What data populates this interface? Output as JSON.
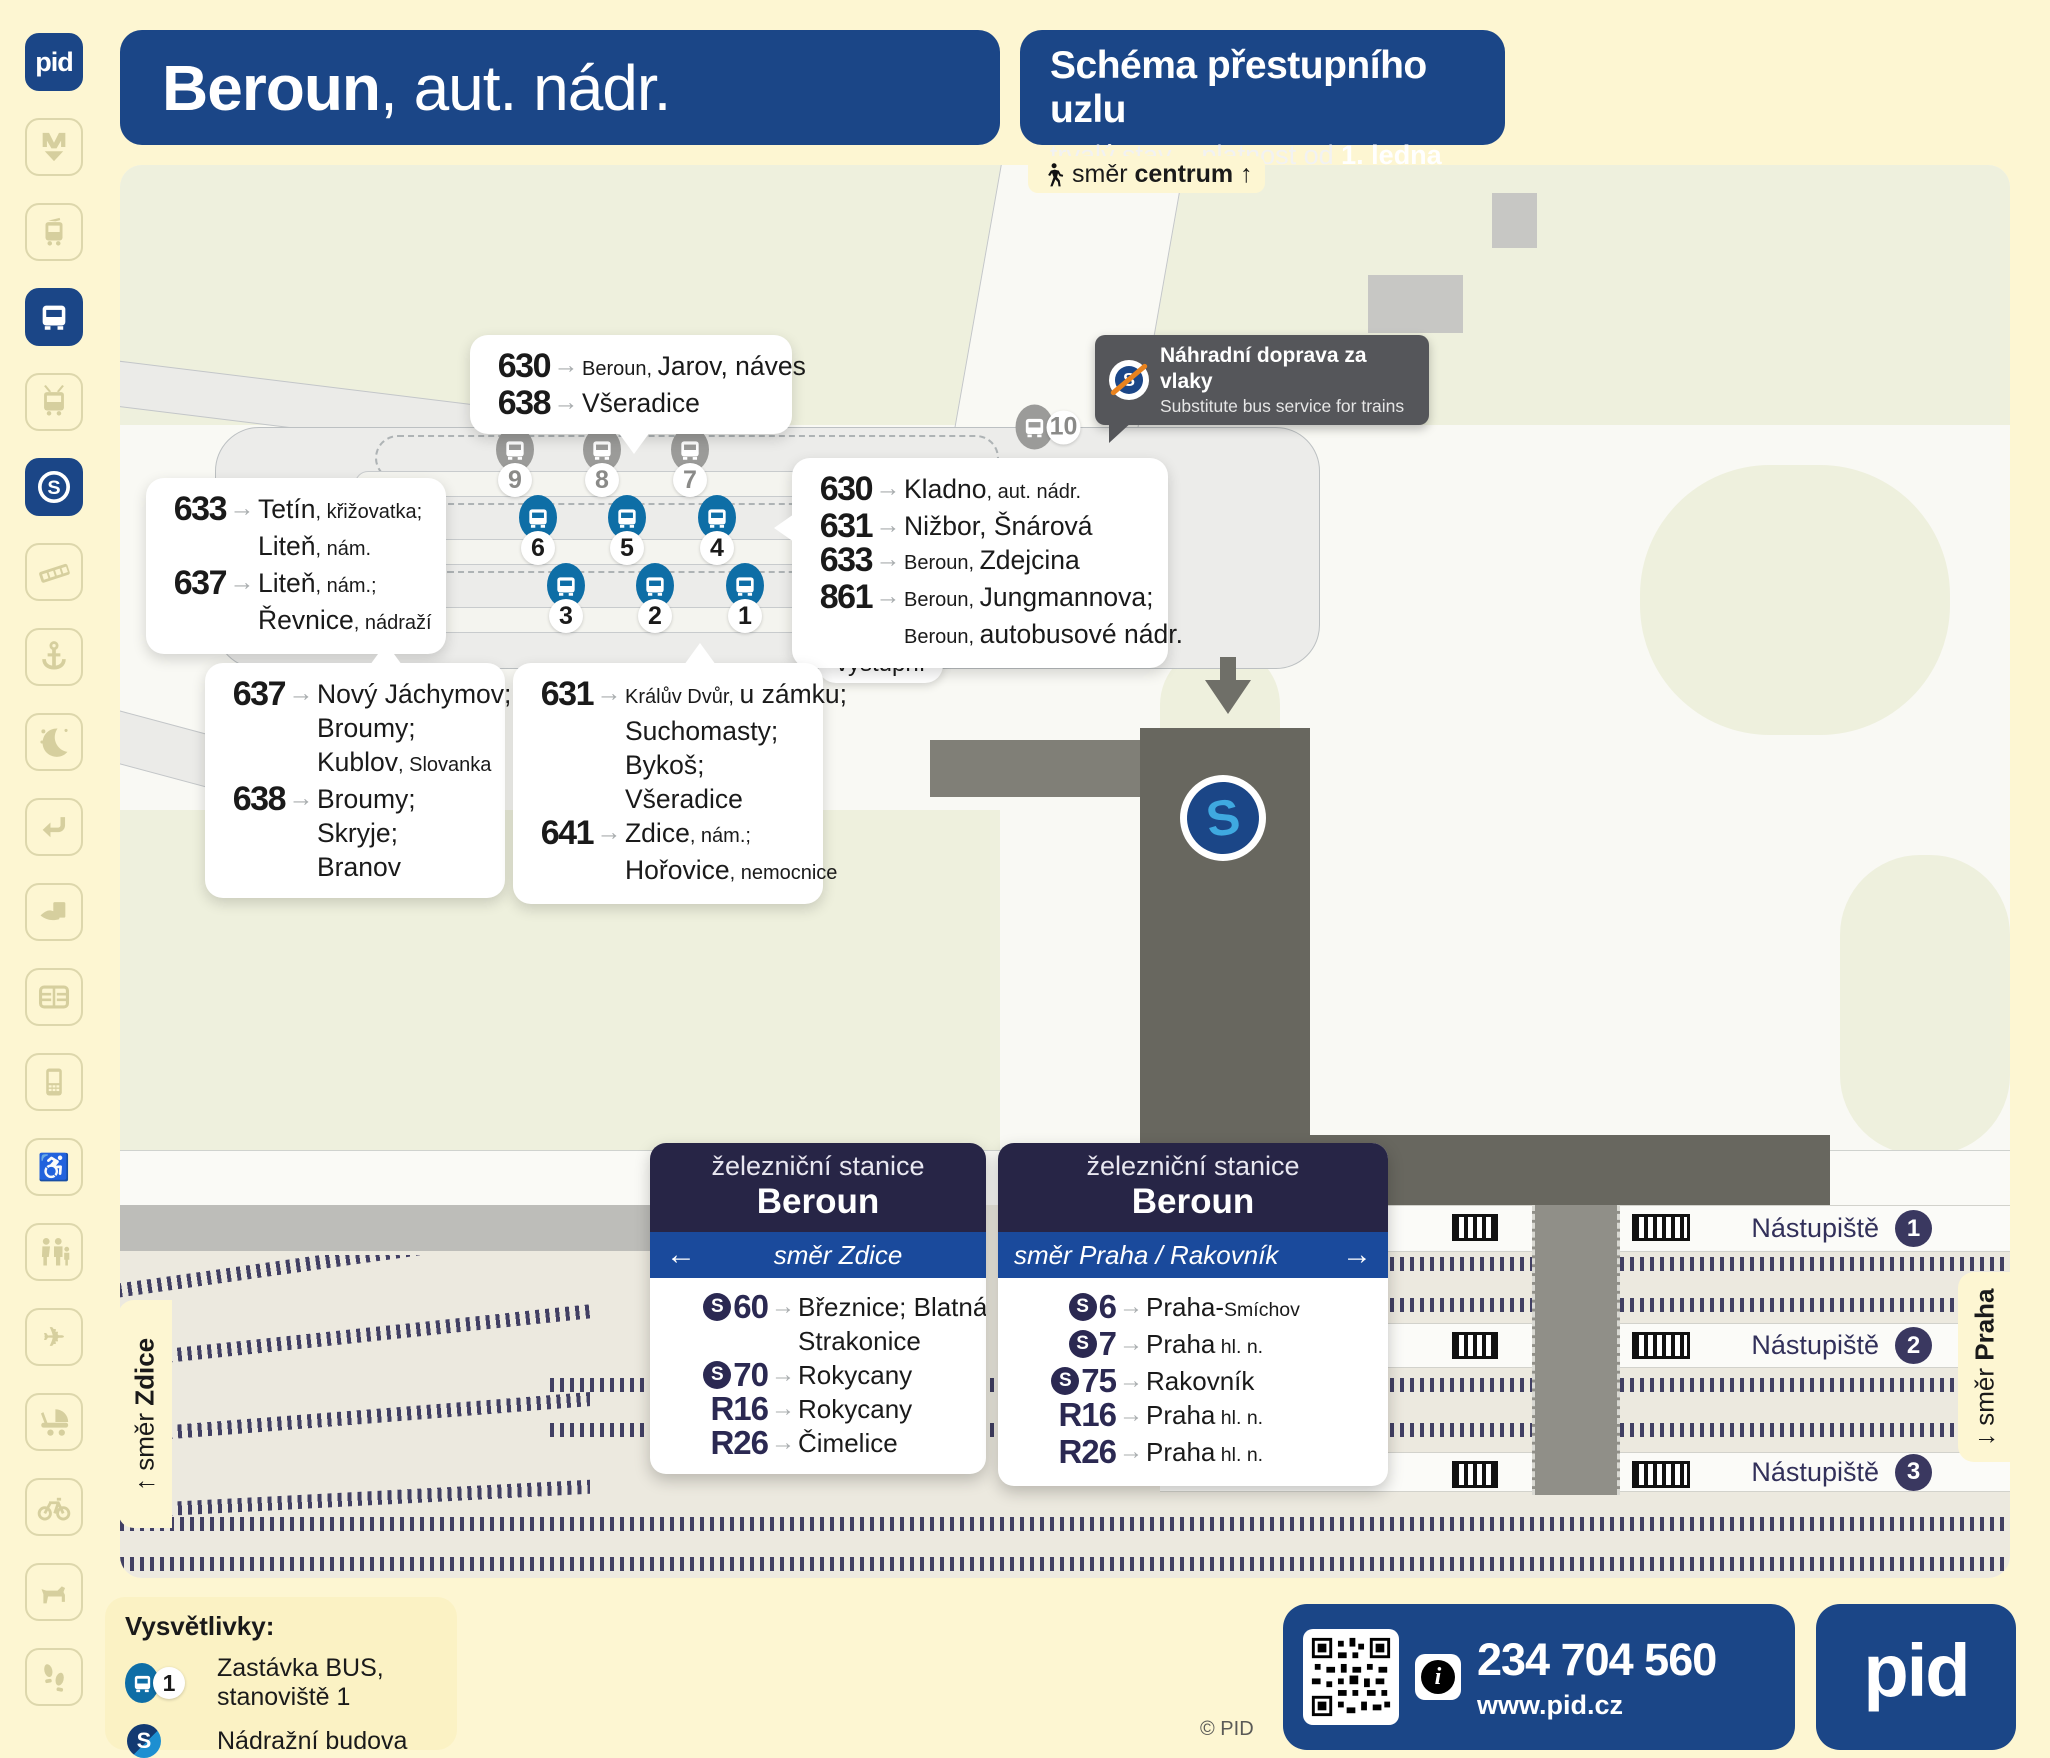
{
  "header": {
    "station_bold": "Beroun",
    "station_rest": ", aut. nádr.",
    "schema_title": "Schéma přestupního uzlu",
    "validity_prefix": "trvalý stav – platnost od ",
    "validity_date": "1. ledna 2026"
  },
  "sidebar": {
    "logo_text": "pid",
    "icons": [
      {
        "id": "metro",
        "active": false
      },
      {
        "id": "tram",
        "active": false
      },
      {
        "id": "bus",
        "active": true
      },
      {
        "id": "trolleybus",
        "active": false
      },
      {
        "id": "s-train",
        "active": true
      },
      {
        "id": "funicular",
        "active": false
      },
      {
        "id": "ferry",
        "active": false
      },
      {
        "id": "night",
        "active": false
      },
      {
        "id": "transfer",
        "active": false
      },
      {
        "id": "ticket",
        "active": false
      },
      {
        "id": "chip-card",
        "active": false
      },
      {
        "id": "mobile",
        "active": false
      },
      {
        "id": "wheelchair",
        "active": false
      },
      {
        "id": "family",
        "active": false
      },
      {
        "id": "airplane",
        "active": false
      },
      {
        "id": "stroller",
        "active": false
      },
      {
        "id": "bicycle",
        "active": false
      },
      {
        "id": "dog",
        "active": false
      },
      {
        "id": "walking",
        "active": false
      }
    ]
  },
  "map": {
    "direction_centrum": {
      "pre": "směr ",
      "bold": "centrum",
      "arrow": "↑"
    },
    "tooltip": {
      "title": "Náhradní doprava za vlaky",
      "subtitle": "Substitute bus service for trains"
    },
    "exit_label": "výstupní",
    "tabs": {
      "left_pre": "↑ směr ",
      "left_bold": "Zdice",
      "right_pre": "↓ směr ",
      "right_bold": "Praha"
    },
    "stops_blue": [
      "1",
      "2",
      "3",
      "4",
      "5",
      "6"
    ],
    "stops_gray": [
      "7",
      "8",
      "9",
      "10"
    ],
    "callouts": [
      {
        "id": "top",
        "routes": [
          {
            "num": "630",
            "dest": [
              [
                {
                  "t": "Beroun, ",
                  "small": true
                },
                {
                  "t": "Jarov, náves"
                }
              ]
            ]
          },
          {
            "num": "638",
            "dest": [
              [
                {
                  "t": "Všeradice"
                }
              ]
            ]
          }
        ]
      },
      {
        "id": "left",
        "routes": [
          {
            "num": "633",
            "dest": [
              [
                {
                  "t": "Tetín"
                },
                {
                  "t": ", křižovatka;",
                  "small": true
                }
              ],
              [
                {
                  "t": "Liteň"
                },
                {
                  "t": ", nám.",
                  "small": true
                }
              ]
            ]
          },
          {
            "num": "637",
            "dest": [
              [
                {
                  "t": "Liteň"
                },
                {
                  "t": ", nám.;",
                  "small": true
                }
              ],
              [
                {
                  "t": "Řevnice"
                },
                {
                  "t": ", nádraží",
                  "small": true
                }
              ]
            ]
          }
        ]
      },
      {
        "id": "right",
        "routes": [
          {
            "num": "630",
            "dest": [
              [
                {
                  "t": "Kladno"
                },
                {
                  "t": ", aut. nádr.",
                  "small": true
                }
              ]
            ]
          },
          {
            "num": "631",
            "dest": [
              [
                {
                  "t": "Nižbor, Šnárová"
                }
              ]
            ]
          },
          {
            "num": "633",
            "dest": [
              [
                {
                  "t": "Beroun, ",
                  "small": true
                },
                {
                  "t": "Zdejcina"
                }
              ]
            ]
          },
          {
            "num": "861",
            "dest": [
              [
                {
                  "t": "Beroun, ",
                  "small": true
                },
                {
                  "t": "Jungmannova;"
                }
              ],
              [
                {
                  "t": "Beroun, ",
                  "small": true
                },
                {
                  "t": "autobusové nádr."
                }
              ]
            ]
          }
        ]
      },
      {
        "id": "bottom-left",
        "routes": [
          {
            "num": "637",
            "dest": [
              [
                {
                  "t": "Nový Jáchymov;"
                }
              ],
              [
                {
                  "t": "Broumy;"
                }
              ],
              [
                {
                  "t": "Kublov"
                },
                {
                  "t": ", Slovanka",
                  "small": true
                }
              ]
            ]
          },
          {
            "num": "638",
            "dest": [
              [
                {
                  "t": "Broumy;"
                }
              ],
              [
                {
                  "t": "Skryje;"
                }
              ],
              [
                {
                  "t": "Branov"
                }
              ]
            ]
          }
        ]
      },
      {
        "id": "bottom-mid",
        "routes": [
          {
            "num": "631",
            "dest": [
              [
                {
                  "t": "Králův Dvůr, ",
                  "small": true
                },
                {
                  "t": "u zámku;"
                }
              ],
              [
                {
                  "t": "Suchomasty;"
                }
              ],
              [
                {
                  "t": "Bykoš;"
                }
              ],
              [
                {
                  "t": "Všeradice"
                }
              ]
            ]
          },
          {
            "num": "641",
            "dest": [
              [
                {
                  "t": "Zdice"
                },
                {
                  "t": ", nám.;",
                  "small": true
                }
              ],
              [
                {
                  "t": "Hořovice"
                },
                {
                  "t": ", nemocnice",
                  "small": true
                }
              ]
            ]
          }
        ]
      }
    ],
    "train_boxes": [
      {
        "id": "zdice",
        "station_label": "železniční stanice",
        "station_name": "Beroun",
        "direction": "směr Zdice",
        "arrow": "←",
        "arrow_side": "left",
        "routes": [
          {
            "badge": "S60",
            "s": true,
            "dest": [
              [
                {
                  "t": "Březnice; Blatná;"
                }
              ],
              [
                {
                  "t": "Strakonice"
                }
              ]
            ]
          },
          {
            "badge": "S70",
            "s": true,
            "dest": [
              [
                {
                  "t": "Rokycany"
                }
              ]
            ]
          },
          {
            "badge": "R16",
            "s": false,
            "dest": [
              [
                {
                  "t": "Rokycany"
                }
              ]
            ]
          },
          {
            "badge": "R26",
            "s": false,
            "dest": [
              [
                {
                  "t": "Čimelice"
                }
              ]
            ]
          }
        ]
      },
      {
        "id": "praha",
        "station_label": "železniční stanice",
        "station_name": "Beroun",
        "direction": "směr Praha / Rakovník",
        "arrow": "→",
        "arrow_side": "right",
        "routes": [
          {
            "badge": "S6",
            "s": true,
            "dest": [
              [
                {
                  "t": "Praha-"
                },
                {
                  "t": "Smíchov",
                  "small": true
                }
              ]
            ]
          },
          {
            "badge": "S7",
            "s": true,
            "dest": [
              [
                {
                  "t": "Praha"
                },
                {
                  "t": " hl. n.",
                  "small": true
                }
              ]
            ]
          },
          {
            "badge": "S75",
            "s": true,
            "dest": [
              [
                {
                  "t": "Rakovník"
                }
              ]
            ]
          },
          {
            "badge": "R16",
            "s": false,
            "dest": [
              [
                {
                  "t": "Praha"
                },
                {
                  "t": " hl. n.",
                  "small": true
                }
              ]
            ]
          },
          {
            "badge": "R26",
            "s": false,
            "dest": [
              [
                {
                  "t": "Praha"
                },
                {
                  "t": " hl. n.",
                  "small": true
                }
              ]
            ]
          }
        ]
      }
    ],
    "platforms": [
      {
        "label": "Nástupiště",
        "num": "1"
      },
      {
        "label": "Nástupiště",
        "num": "2"
      },
      {
        "label": "Nástupiště",
        "num": "3"
      }
    ]
  },
  "legend": {
    "title": "Vysvětlivky:",
    "items": [
      {
        "icon": "bus-stop",
        "badge": "1",
        "text": "Zastávka BUS, stanoviště 1"
      },
      {
        "icon": "s-logo",
        "badge": "",
        "text": "Nádražní budova"
      }
    ]
  },
  "footer": {
    "phone": "234 704 560",
    "web": "www.pid.cz",
    "copyright": "© PID",
    "logo_text": "pid"
  }
}
